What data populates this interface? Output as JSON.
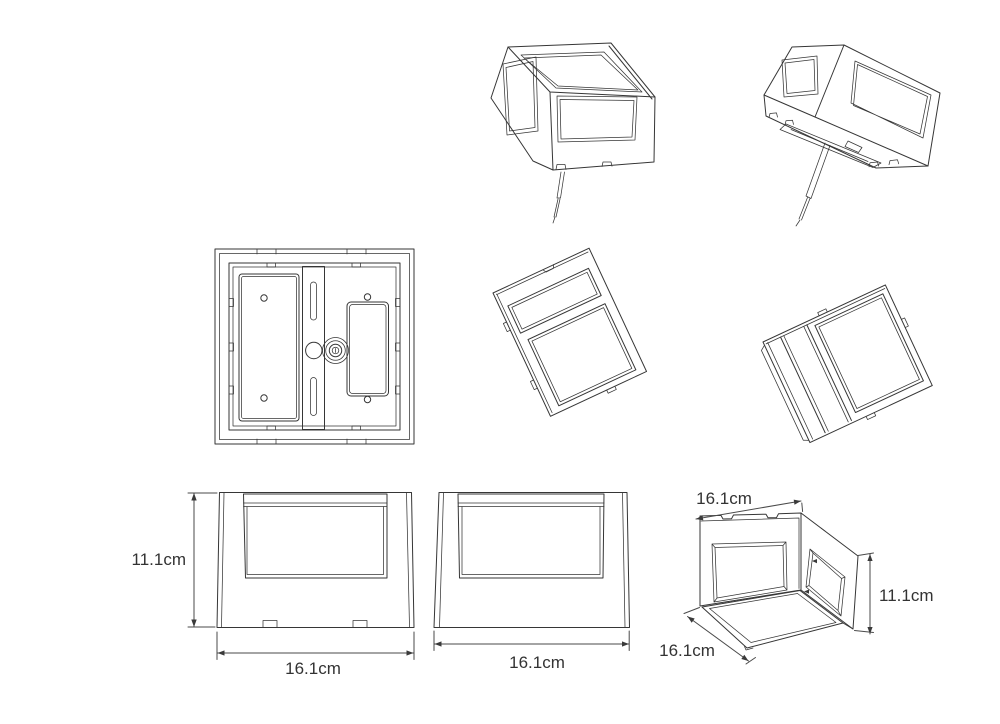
{
  "drawing": {
    "background": "#ffffff",
    "line_color": "#363636",
    "dimension_line_color": "#4a4a4a",
    "label_color": "#333333"
  },
  "labels": {
    "side_height": "11.1cm",
    "side_width": "16.1cm",
    "front_width": "16.1cm",
    "iso_width": "16.1cm",
    "iso_depth": "16.1cm",
    "iso_height": "11.1cm"
  }
}
